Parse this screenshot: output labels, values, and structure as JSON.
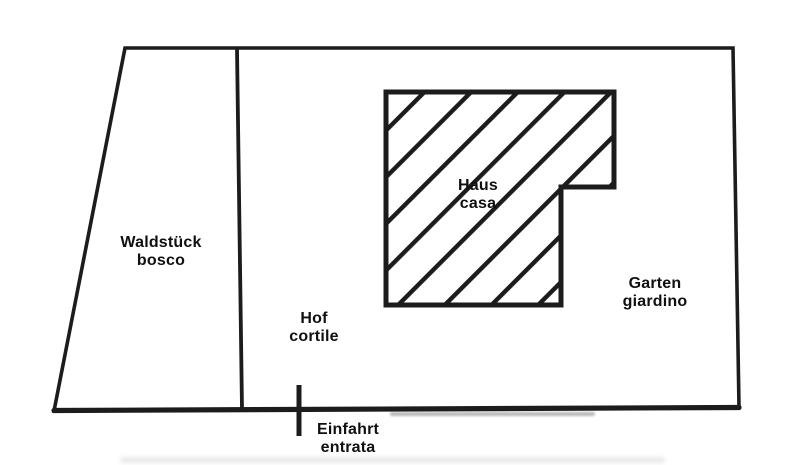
{
  "diagram": {
    "type": "property-sketch-plan",
    "languages": [
      "de",
      "it"
    ],
    "colors": {
      "line": "#1c1c1c",
      "text": "#101010",
      "background": "#ffffff"
    },
    "labels": {
      "waldstueck": {
        "de": "Waldstück",
        "it": "bosco"
      },
      "hof": {
        "de": "Hof",
        "it": "cortile"
      },
      "haus": {
        "de": "Haus",
        "it": "casa"
      },
      "garten": {
        "de": "Garten",
        "it": "giardino"
      },
      "einfahrt": {
        "de": "Einfahrt",
        "it": "entrata"
      }
    }
  }
}
